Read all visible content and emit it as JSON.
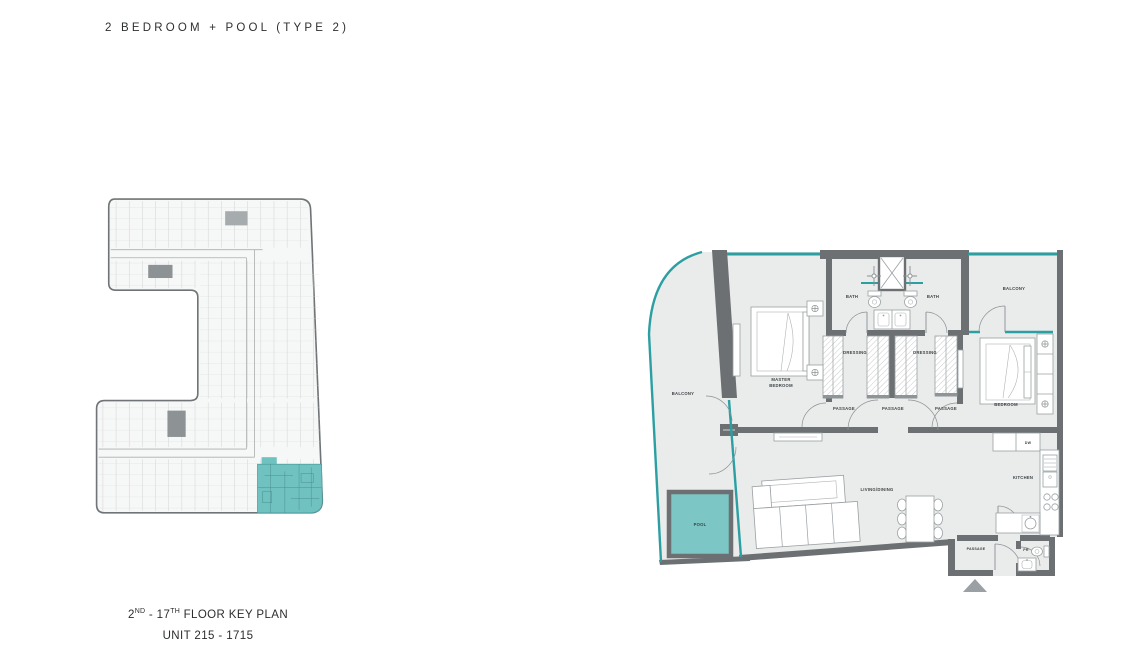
{
  "title": "2 BEDROOM + POOL (TYPE 2)",
  "key_plan": {
    "floor_label": {
      "n1": "2",
      "s1": "ND",
      "mid": " - 17",
      "s2": "TH",
      "rest": " FLOOR KEY PLAN"
    },
    "unit_label": "UNIT 215 - 1715"
  },
  "unit_plan": {
    "rooms": {
      "balcony_left": "BALCONY",
      "master_bedroom_line1": "MASTER",
      "master_bedroom_line2": "BEDROOM",
      "bath_left": "BATH",
      "bath_right": "BATH",
      "balcony_right": "BALCONY",
      "dressing_left": "DRESSING",
      "dressing_right": "DRESSING",
      "passage_left": "PASSAGE",
      "passage_center": "PASSAGE",
      "passage_right": "PASSAGE",
      "bedroom": "BEDROOM",
      "living_dining": "LIVING/DINING",
      "kitchen": "KITCHEN",
      "dishwasher": "DW",
      "pool": "POOL",
      "passage_entry": "PASSAGE",
      "powder_room": "PR"
    }
  },
  "colors": {
    "accent_teal": "#2B9FA2",
    "pool_fill": "#7CC6C5",
    "key_plan_highlight": "#70C2C1",
    "wall_gray": "#6C7072",
    "floor_gray": "#EAEBEB",
    "label_gray": "#3C4345"
  }
}
